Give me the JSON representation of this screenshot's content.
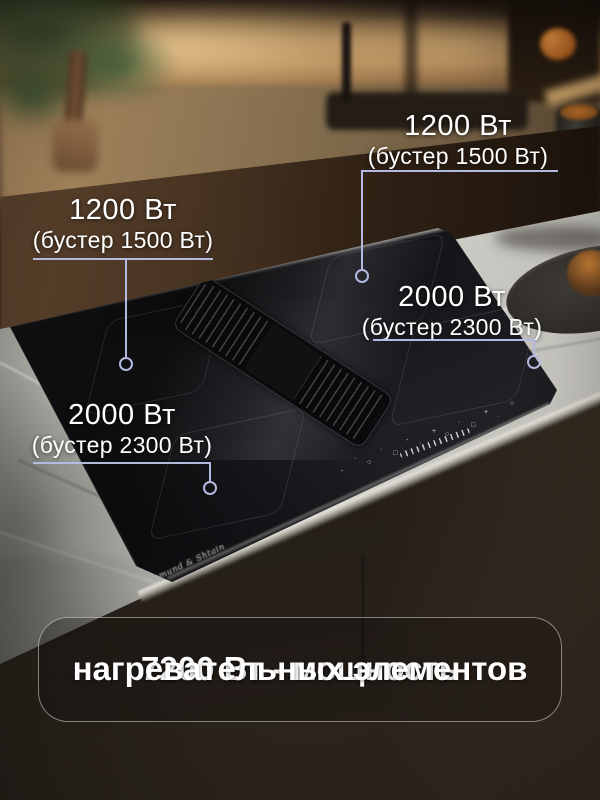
{
  "callouts": [
    {
      "id": "back-left-zone",
      "power": "1200 Вт",
      "booster": "(бустер 1500 Вт)"
    },
    {
      "id": "back-right-zone",
      "power": "1200 Вт",
      "booster": "(бустер 1500 Вт)"
    },
    {
      "id": "right-zone",
      "power": "2000 Вт",
      "booster": "(бустер 2300 Вт)"
    },
    {
      "id": "front-left-zone",
      "power": "2000 Вт",
      "booster": "(бустер 2300 Вт)"
    }
  ],
  "summary": {
    "line1": "7200 Вт - мощность",
    "line2": "нагревательных элементов"
  },
  "hob": {
    "brand": "Zigmund & Shtain",
    "control_glyphs": [
      "-",
      "·",
      "○",
      "·",
      "□",
      "-",
      "·",
      "+",
      "○",
      "·",
      "□",
      "+",
      "·",
      "○"
    ]
  },
  "colors": {
    "callout_line": "#b3b9e0",
    "label_text": "#ffffff",
    "panel_border": "rgba(235,235,230,0.5)",
    "panel_background": "rgba(15,12,9,0.28)"
  }
}
